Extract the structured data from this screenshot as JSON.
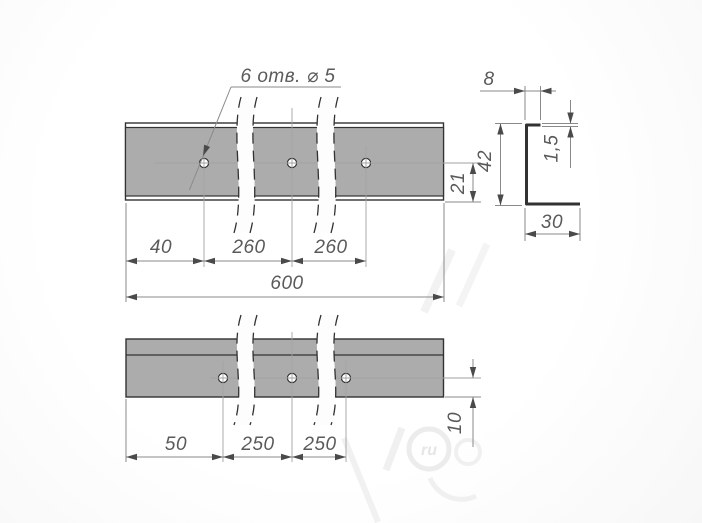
{
  "callout": {
    "text": "6 отв. ⌀ 5"
  },
  "top_view": {
    "dim_40": "40",
    "dim_260a": "260",
    "dim_260b": "260",
    "dim_600": "600",
    "dim_21": "21"
  },
  "section_view": {
    "dim_8": "8",
    "dim_1_5": "1,5",
    "dim_42": "42",
    "dim_30": "30"
  },
  "bottom_view": {
    "dim_50": "50",
    "dim_250a": "250",
    "dim_250b": "250",
    "dim_10": "10"
  },
  "watermark": {
    "text": "ru"
  },
  "colors": {
    "bar_fill": "#acacac",
    "outline": "#323232",
    "dim_line": "#8a8a8a",
    "centerline": "#a2a2a2",
    "arrow": "#4a4a4a",
    "text": "#5a5a5a",
    "watermark": "#ececec"
  }
}
